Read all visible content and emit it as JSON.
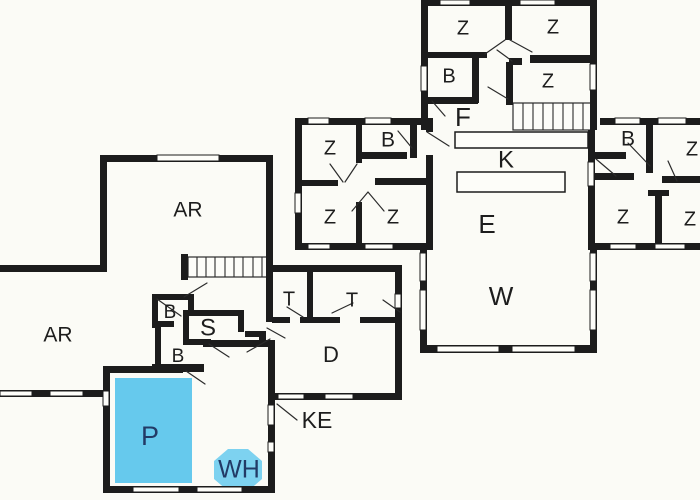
{
  "colors": {
    "wall": "#1c1c1c",
    "line": "#2b2b2b",
    "background": "#fbfbf6",
    "room_fill": "#fdfdf9",
    "pool": "#66c9ed",
    "whirlpool": "#7dd2f0",
    "label": "#1d1d1d",
    "water_label": "#223a66"
  },
  "plan_lower": {
    "rooms": {
      "ar_top": "AR",
      "ar_left": "AR",
      "b_mid_upper": "B",
      "s_mid": "S",
      "b_mid_lower": "B",
      "t_1": "T",
      "t_2": "T",
      "d_room": "D",
      "p_pool": "P",
      "wh_tub": "WH",
      "ke": "KE"
    }
  },
  "plan_upper": {
    "rooms": {
      "z_top_1": "Z",
      "z_top_2": "Z",
      "b_top": "B",
      "z_top_3": "Z",
      "f_hall": "F",
      "z_w1": "Z",
      "b_w": "B",
      "z_w2": "Z",
      "z_w3": "Z",
      "k": "K",
      "e": "E",
      "w": "W",
      "b_e": "B",
      "z_e1": "Z",
      "z_e2": "Z",
      "z_e3": "Z"
    }
  }
}
